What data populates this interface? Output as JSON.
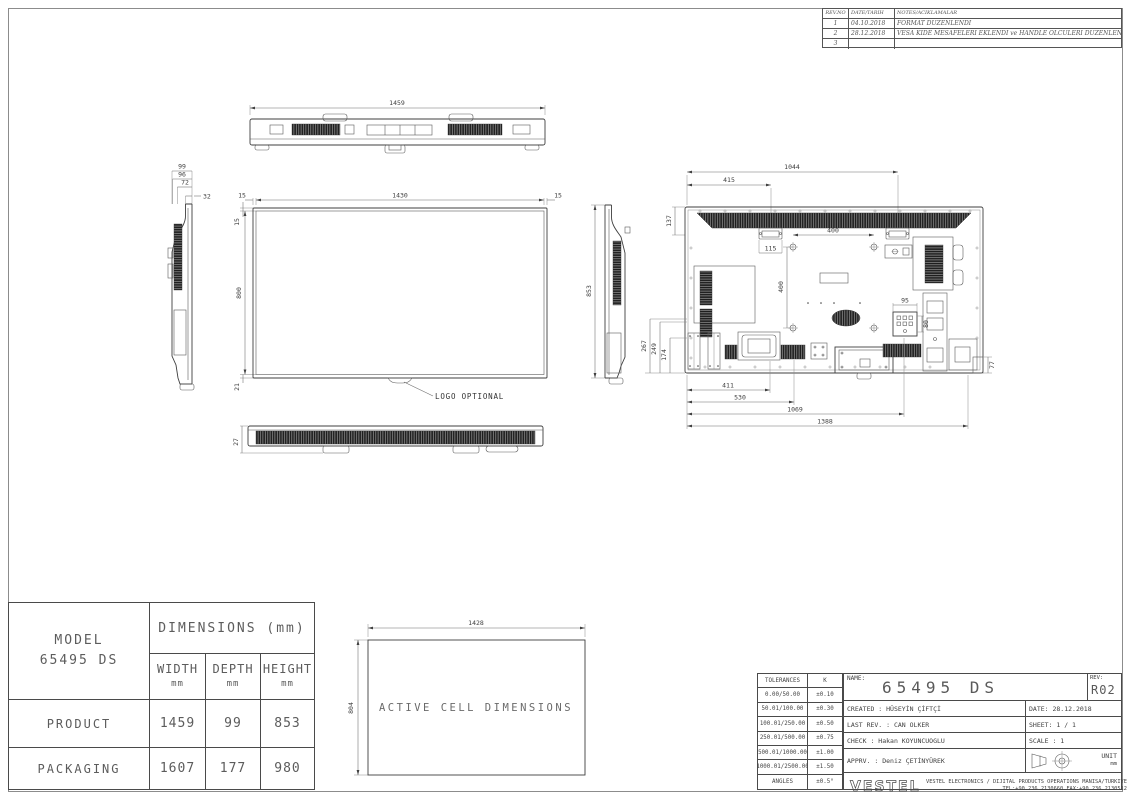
{
  "drawing": {
    "revision_table": {
      "col_rev": "REV.NO",
      "col_date": "DATE/TARIH",
      "col_notes": "NOTES/ACIKLAMALAR",
      "rows": [
        {
          "no": "1",
          "date": "04.10.2018",
          "note": "FORMAT DUZENLENDI"
        },
        {
          "no": "2",
          "date": "28.12.2018",
          "note": "VESA KIDE MESAFELERI EKLENDI ve HANDLE OLCULERI DUZENLENDI"
        },
        {
          "no": "3",
          "date": "",
          "note": ""
        }
      ]
    },
    "top_view": {
      "dim_overall_width": "1459"
    },
    "side_view_left": {
      "dim_depth_total": "99",
      "dim_depth_back": "96",
      "dim_depth_mid": "72",
      "dim_depth_top": "32"
    },
    "front_view": {
      "dim_screen_width": "1430",
      "dim_bezel_left": "15",
      "dim_bezel_right": "15",
      "dim_bezel_top": "15",
      "dim_screen_height": "800",
      "dim_bezel_bottom": "21",
      "logo_label": "LOGO OPTIONAL"
    },
    "bottom_view": {
      "dim_bottom": "27"
    },
    "side_view_right": {
      "dim_height": "853"
    },
    "rear_view": {
      "dim_handle_right": "1044",
      "dim_handle_left": "415",
      "dim_top_offset": "137",
      "dim_handle_width": "115",
      "dim_vesa_h": "400",
      "dim_vesa_v": "400",
      "dim_inlet_w": "95",
      "dim_inlet_h": "80",
      "dim_left_1": "267",
      "dim_left_2": "249",
      "dim_left_3": "174",
      "dim_bottom_1": "411",
      "dim_bottom_2": "530",
      "dim_bottom_3": "1069",
      "dim_bottom_4": "1388",
      "dim_right_bottom": "77"
    },
    "active_cell": {
      "dim_width": "1428",
      "dim_height": "804",
      "label": "ACTIVE CELL DIMENSIONS"
    },
    "dimensions_table": {
      "model_label": "MODEL",
      "model_value": "65495 DS",
      "header": "DIMENSIONS (mm)",
      "col_width": "WIDTH",
      "col_depth": "DEPTH",
      "col_height": "HEIGHT",
      "unit": "mm",
      "rows": [
        {
          "label": "PRODUCT",
          "width": "1459",
          "depth": "99",
          "height": "853"
        },
        {
          "label": "PACKAGING",
          "width": "1607",
          "depth": "177",
          "height": "980"
        }
      ]
    },
    "tolerances": {
      "title": "TOLERANCES",
      "k": "K",
      "rows": [
        {
          "range": "0.00/50.00",
          "value": "±0.10"
        },
        {
          "range": "50.01/100.00",
          "value": "±0.30"
        },
        {
          "range": "100.01/250.00",
          "value": "±0.50"
        },
        {
          "range": "250.01/500.00",
          "value": "±0.75"
        },
        {
          "range": "500.01/1000.00",
          "value": "±1.00"
        },
        {
          "range": "1000.01/2500.00",
          "value": "±1.50"
        },
        {
          "range": "ANGLES",
          "value": "±0.5°"
        }
      ]
    },
    "title_block": {
      "name_label": "NAME:",
      "name_value": "65495 DS",
      "rev_label": "REV:",
      "rev_value": "R02",
      "created": "CREATED : HÜSEYİN ÇİFTÇİ",
      "date": "DATE: 28.12.2018",
      "last_rev": "LAST REV. : CAN OLKER",
      "sheet": "SHEET: 1 / 1",
      "check": "CHECK : Hakan KOYUNCUOGLU",
      "scale": "SCALE : 1",
      "apprv": "APPRV. : Deniz ÇETİNYÜREK",
      "unit_label": "UNIT",
      "unit_value": "mm",
      "logo": "VESTEL",
      "company": "VESTEL ELECTRONICS / DIJITAL PRODUCTS OPERATIONS MANISA/TURKIYE",
      "contact": "TEL:+90.236.2130660 FAX:+90.236.2130512"
    }
  }
}
